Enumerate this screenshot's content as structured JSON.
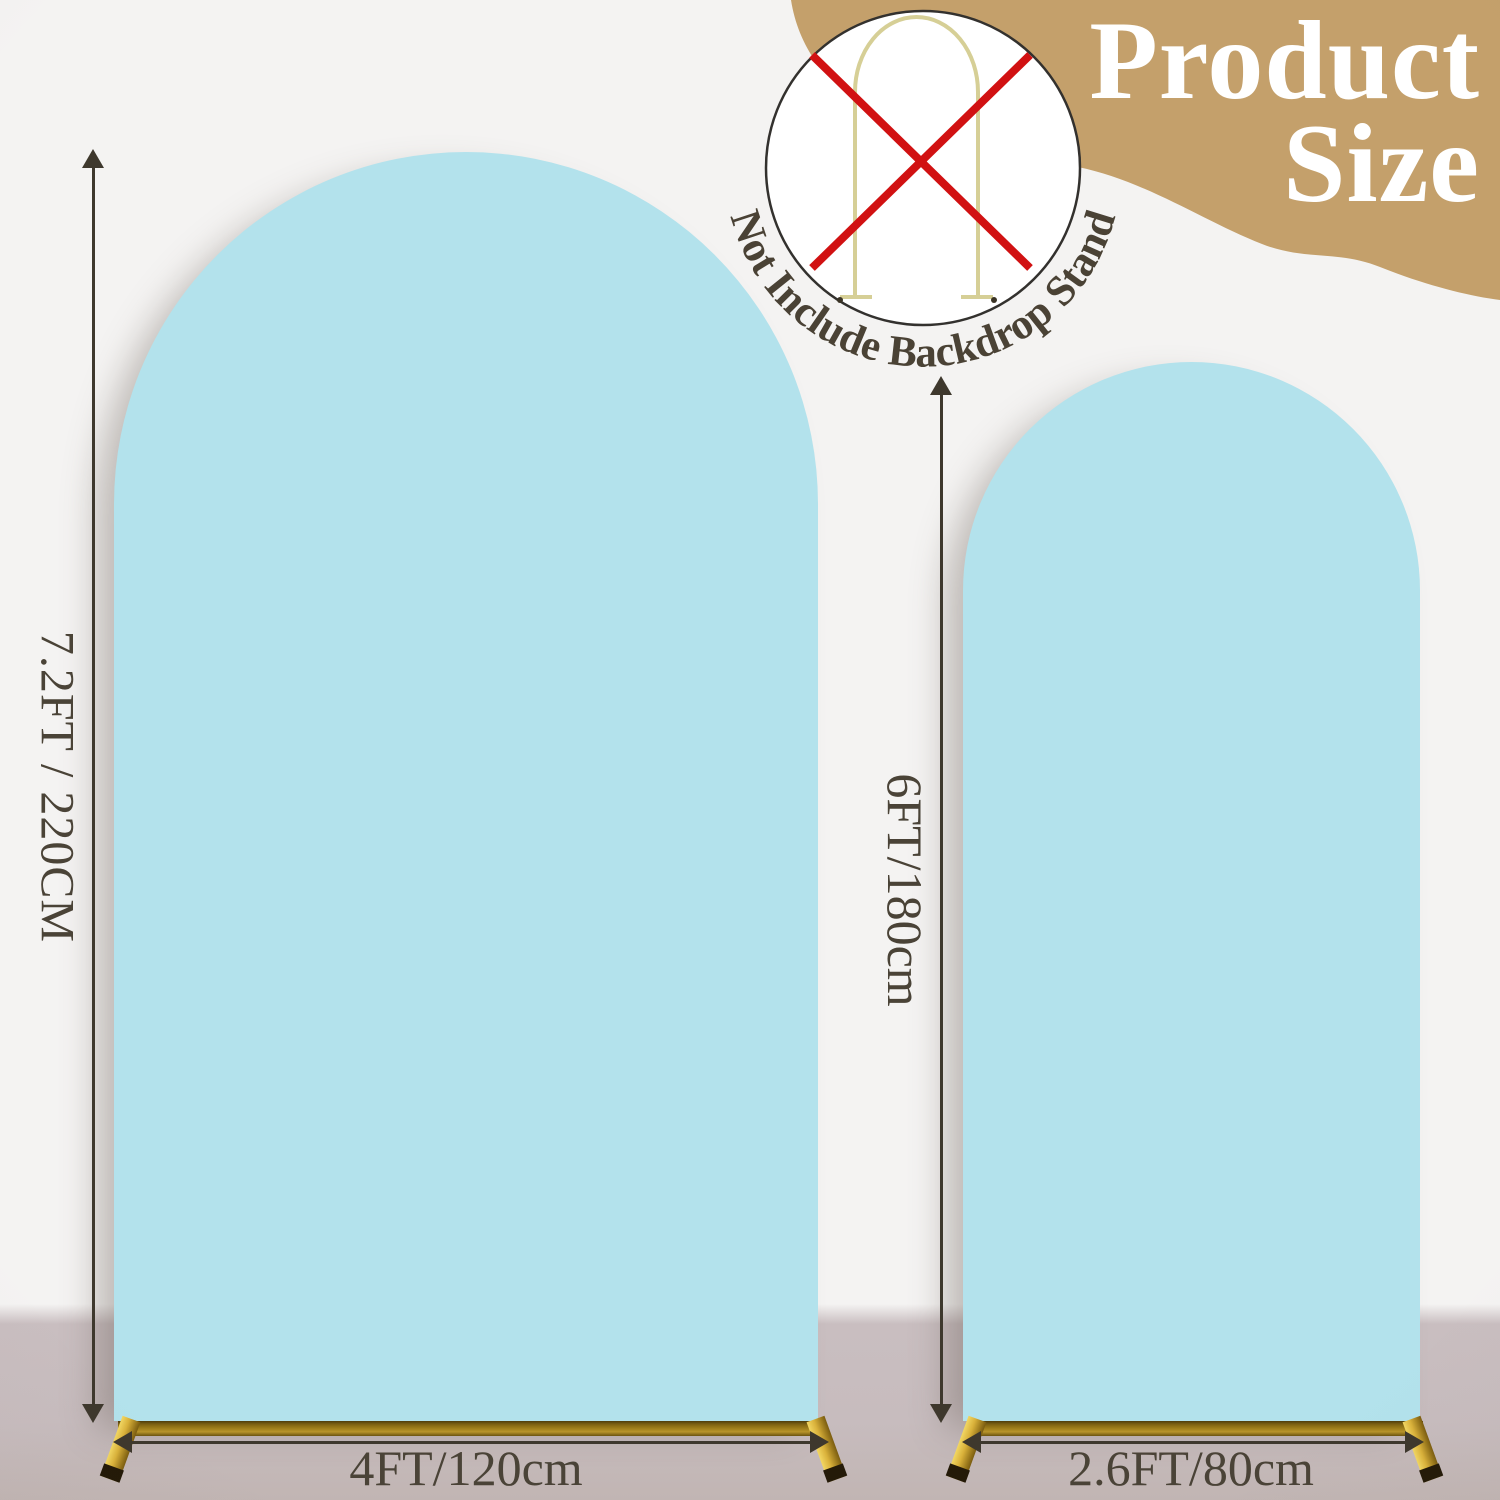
{
  "page": {
    "title_line1": "Product",
    "title_line2": "Size"
  },
  "badge": {
    "label": "Not Include Backdrop Stand"
  },
  "arches": {
    "large": {
      "height_label": "7.2FT / 220CM",
      "width_label": "4FT/120cm"
    },
    "small": {
      "height_label": "6FT/180cm",
      "width_label": "2.6FT/80cm"
    }
  },
  "colors": {
    "arch_fill": "#b3e2ec",
    "accent_tan": "#c4a06b",
    "gold_bar": "#9a7a18",
    "gold_foot": "#d9b13a",
    "cross_red": "#d11112",
    "text_dark": "#4a4337",
    "title_white": "#ffffff",
    "wall": "#f4f3f2",
    "floor": "#c9bec0"
  }
}
